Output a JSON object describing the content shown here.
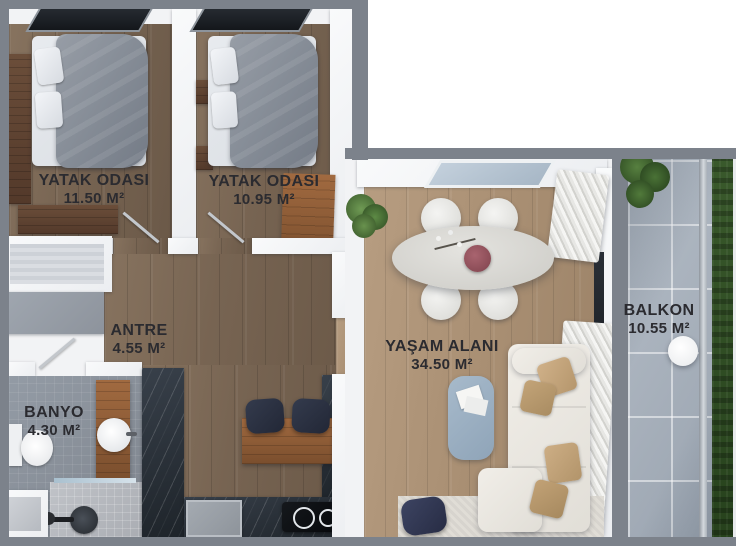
{
  "rooms": [
    {
      "id": "yatak-odasi-1",
      "label": "YATAK ODASI",
      "area": "11.50 M²"
    },
    {
      "id": "yatak-odasi-2",
      "label": "YATAK ODASI",
      "area": "10.95 M²"
    },
    {
      "id": "antre",
      "label": "ANTRE",
      "area": "4.55 M²"
    },
    {
      "id": "banyo",
      "label": "BANYO",
      "area": "4.30 M²"
    },
    {
      "id": "yasam-alani",
      "label": "YAŞAM ALANI",
      "area": "34.50 M²"
    },
    {
      "id": "balkon",
      "label": "BALKON",
      "area": "10.55 M²"
    }
  ],
  "colors": {
    "border_gray": "#7c828b",
    "wall_white": "#f2f3f5",
    "wood_dark": "#776452",
    "wood_light": "#a98f73",
    "wood_furniture": "#8a5c39",
    "bath_tile": "#8b919c",
    "balcony_tile": "#a9b2bc",
    "grass_green": "#2d4723",
    "counter_marble": "#272d34",
    "bed_gray": "#878e97",
    "sofa_cream": "#ebe8e2",
    "pillow_tan": "#c5a77d",
    "coffee_table_blue": "#9cb0c4",
    "stool_navy": "#2b3140",
    "vase_maroon": "#91505a",
    "label_text": "#2b2b30"
  }
}
